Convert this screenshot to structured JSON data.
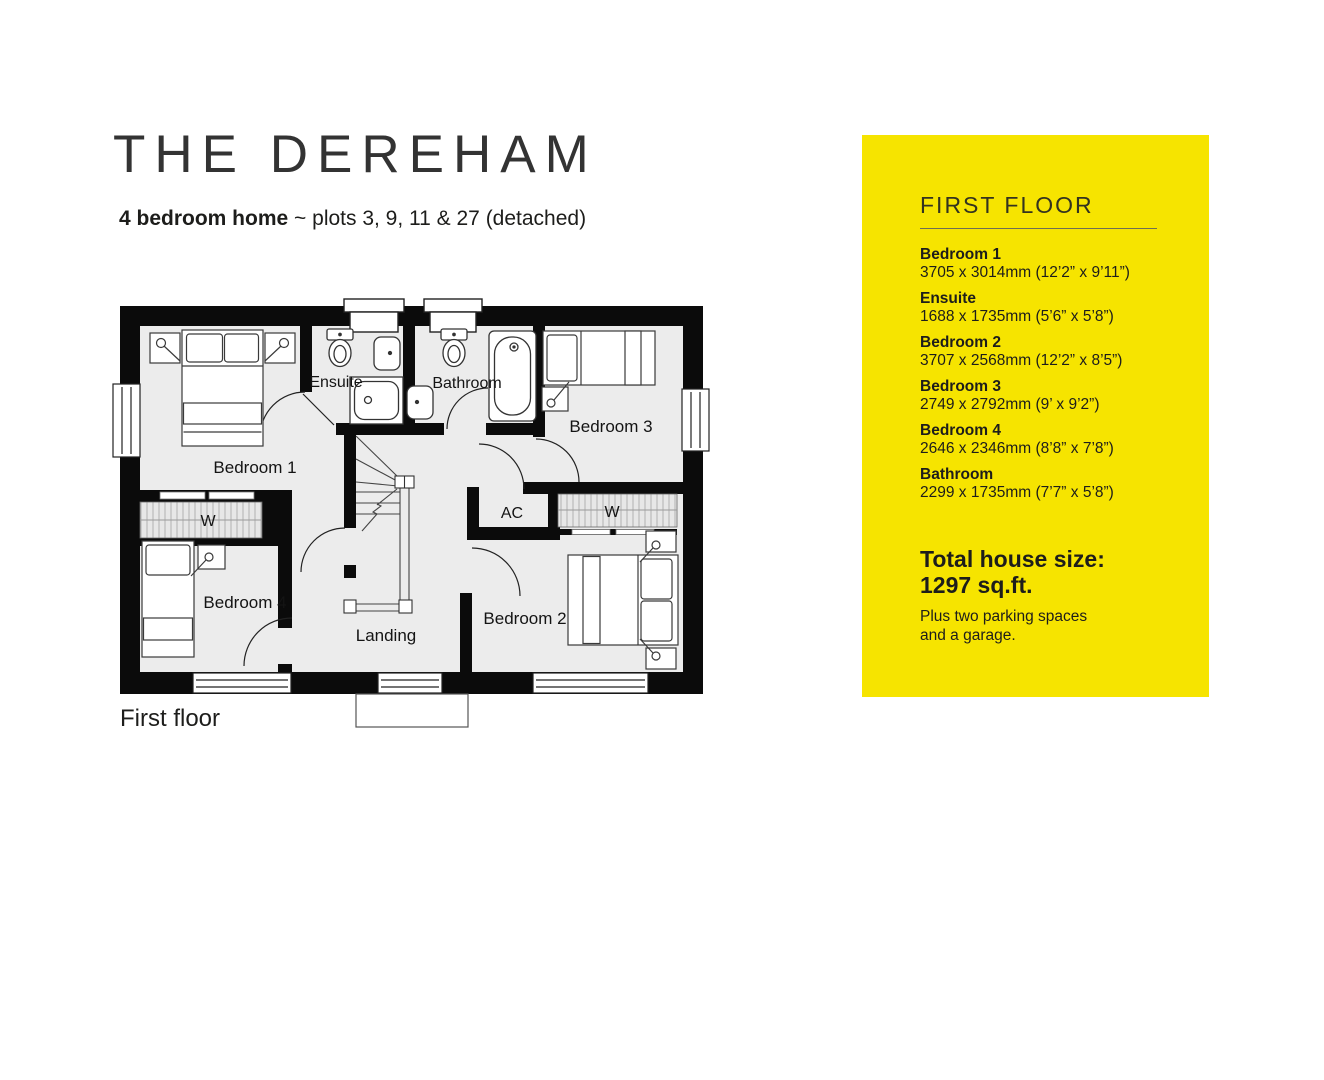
{
  "header": {
    "title": "THE DEREHAM",
    "subtitle_bold": "4 bedroom home",
    "subtitle_rest": " ~ plots 3, 9, 11 & 27 (detached)"
  },
  "plan": {
    "caption": "First floor",
    "labels": {
      "bedroom1": "Bedroom 1",
      "bedroom2": "Bedroom 2",
      "bedroom3": "Bedroom 3",
      "bedroom4": "Bedroom 4",
      "ensuite": "Ensuite",
      "bathroom": "Bathroom",
      "landing": "Landing",
      "ac": "AC",
      "wardrobe_left": "W",
      "wardrobe_right": "W"
    }
  },
  "panel": {
    "heading": "FIRST FLOOR",
    "rooms": [
      {
        "name": "Bedroom 1",
        "dims": "3705 x 3014mm (12’2” x 9’11”)"
      },
      {
        "name": "Ensuite",
        "dims": "1688 x 1735mm (5’6” x 5’8”)"
      },
      {
        "name": "Bedroom 2",
        "dims": "3707 x 2568mm (12’2” x 8’5”)"
      },
      {
        "name": "Bedroom 3",
        "dims": "2749 x 2792mm (9’ x 9’2”)"
      },
      {
        "name": "Bedroom 4",
        "dims": "2646 x 2346mm (8’8” x 7’8”)"
      },
      {
        "name": "Bathroom",
        "dims": "2299 x 1735mm (7’7” x 5’8”)"
      }
    ],
    "total_label": "Total house size:",
    "total_value": "1297 sq.ft.",
    "note_line1": "Plus two parking spaces",
    "note_line2": "and a garage."
  },
  "colors": {
    "panel_yellow": "#F6E400",
    "wall_black": "#0b0b0b",
    "floor_grey": "#ECECEC"
  }
}
